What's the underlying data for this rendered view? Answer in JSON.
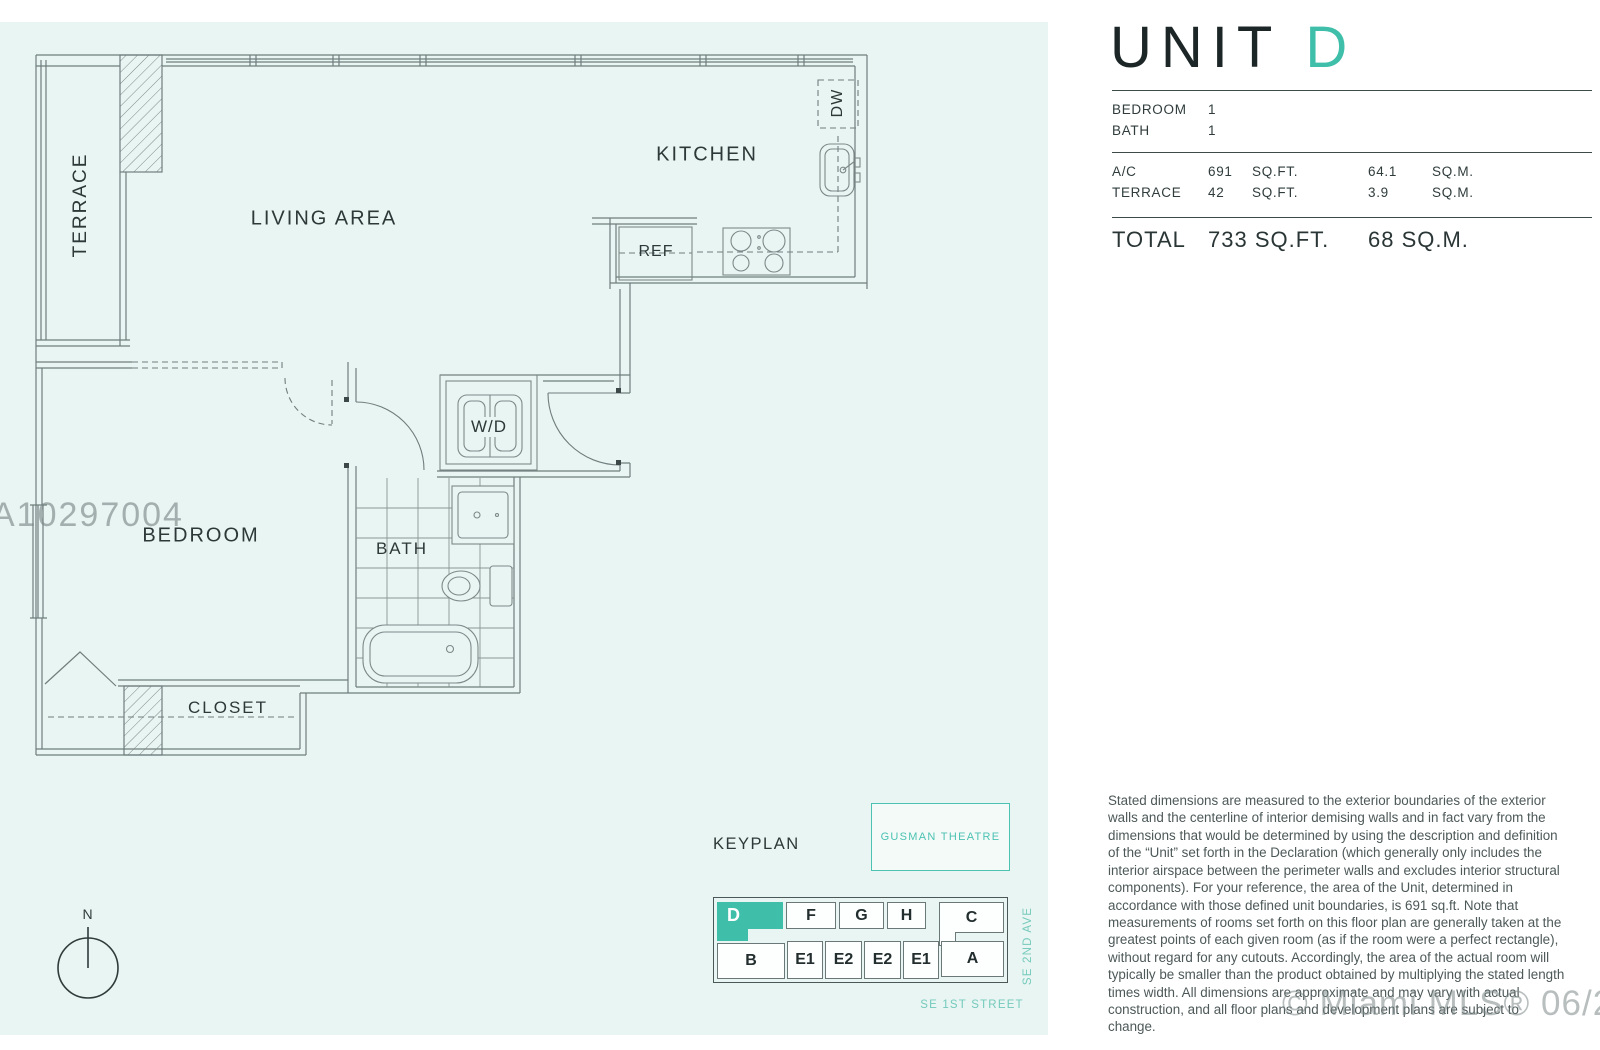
{
  "unit_header": {
    "title_prefix": "UNIT",
    "title_letter": "D"
  },
  "stats": {
    "bedroom_label": "BEDROOM",
    "bedroom_value": "1",
    "bath_label": "BATH",
    "bath_value": "1",
    "ac_label": "A/C",
    "ac_sqft": "691",
    "ac_sqm": "64.1",
    "terrace_label": "TERRACE",
    "terrace_sqft": "42",
    "terrace_sqm": "3.9",
    "sqft_unit": "SQ.FT.",
    "sqm_unit": "SQ.M.",
    "total_label": "TOTAL",
    "total_sqft": "733 SQ.FT.",
    "total_sqm": "68 SQ.M."
  },
  "floor_plan": {
    "rooms": {
      "terrace": "TERRACE",
      "living": "LIVING AREA",
      "kitchen": "KITCHEN",
      "bedroom": "BEDROOM",
      "bath": "BATH",
      "closet": "CLOSET",
      "washer_dryer": "W/D",
      "refrigerator": "REF",
      "dishwasher": "DW"
    },
    "north_label": "N",
    "watermark": "A10297004"
  },
  "keyplan": {
    "label": "KEYPLAN",
    "theatre": "GUSMAN THEATRE",
    "streets": {
      "avenue": "SE 2ND AVE",
      "street": "SE 1ST STREET"
    },
    "units_top": [
      "D",
      "F",
      "G",
      "H",
      "C"
    ],
    "units_bottom": [
      "B",
      "E1",
      "E2",
      "E2",
      "E1",
      "A"
    ],
    "highlighted_unit": "D"
  },
  "disclaimer": "Stated dimensions are measured to the exterior boundaries of the exterior walls and the centerline of interior demising walls and in fact vary from the dimensions that would be determined by using the description and definition of the “Unit” set forth in the Declaration (which generally only includes the interior airspace between the perimeter walls and excludes interior structural components).  For your reference, the area of the Unit, determined in accordance with those defined unit boundaries, is 691 sq.ft. Note that measurements of rooms set forth on this floor plan are generally taken at the greatest points of each given room (as if the room were a perfect rectangle), without regard for any cutouts.  Accordingly, the area of the actual room will typically be smaller than the product obtained by multiplying the stated length times width.  All dimensions are approximate and may vary with actual construction, and all floor plans and development plans are subject to change.",
  "mls_watermark": "© Miami MLS® 06/2017",
  "colors": {
    "accent_teal": "#3fbfa9",
    "street_teal": "#74cabc",
    "plan_background": "#e9f5f2",
    "wall_line": "#6f7d7d"
  }
}
